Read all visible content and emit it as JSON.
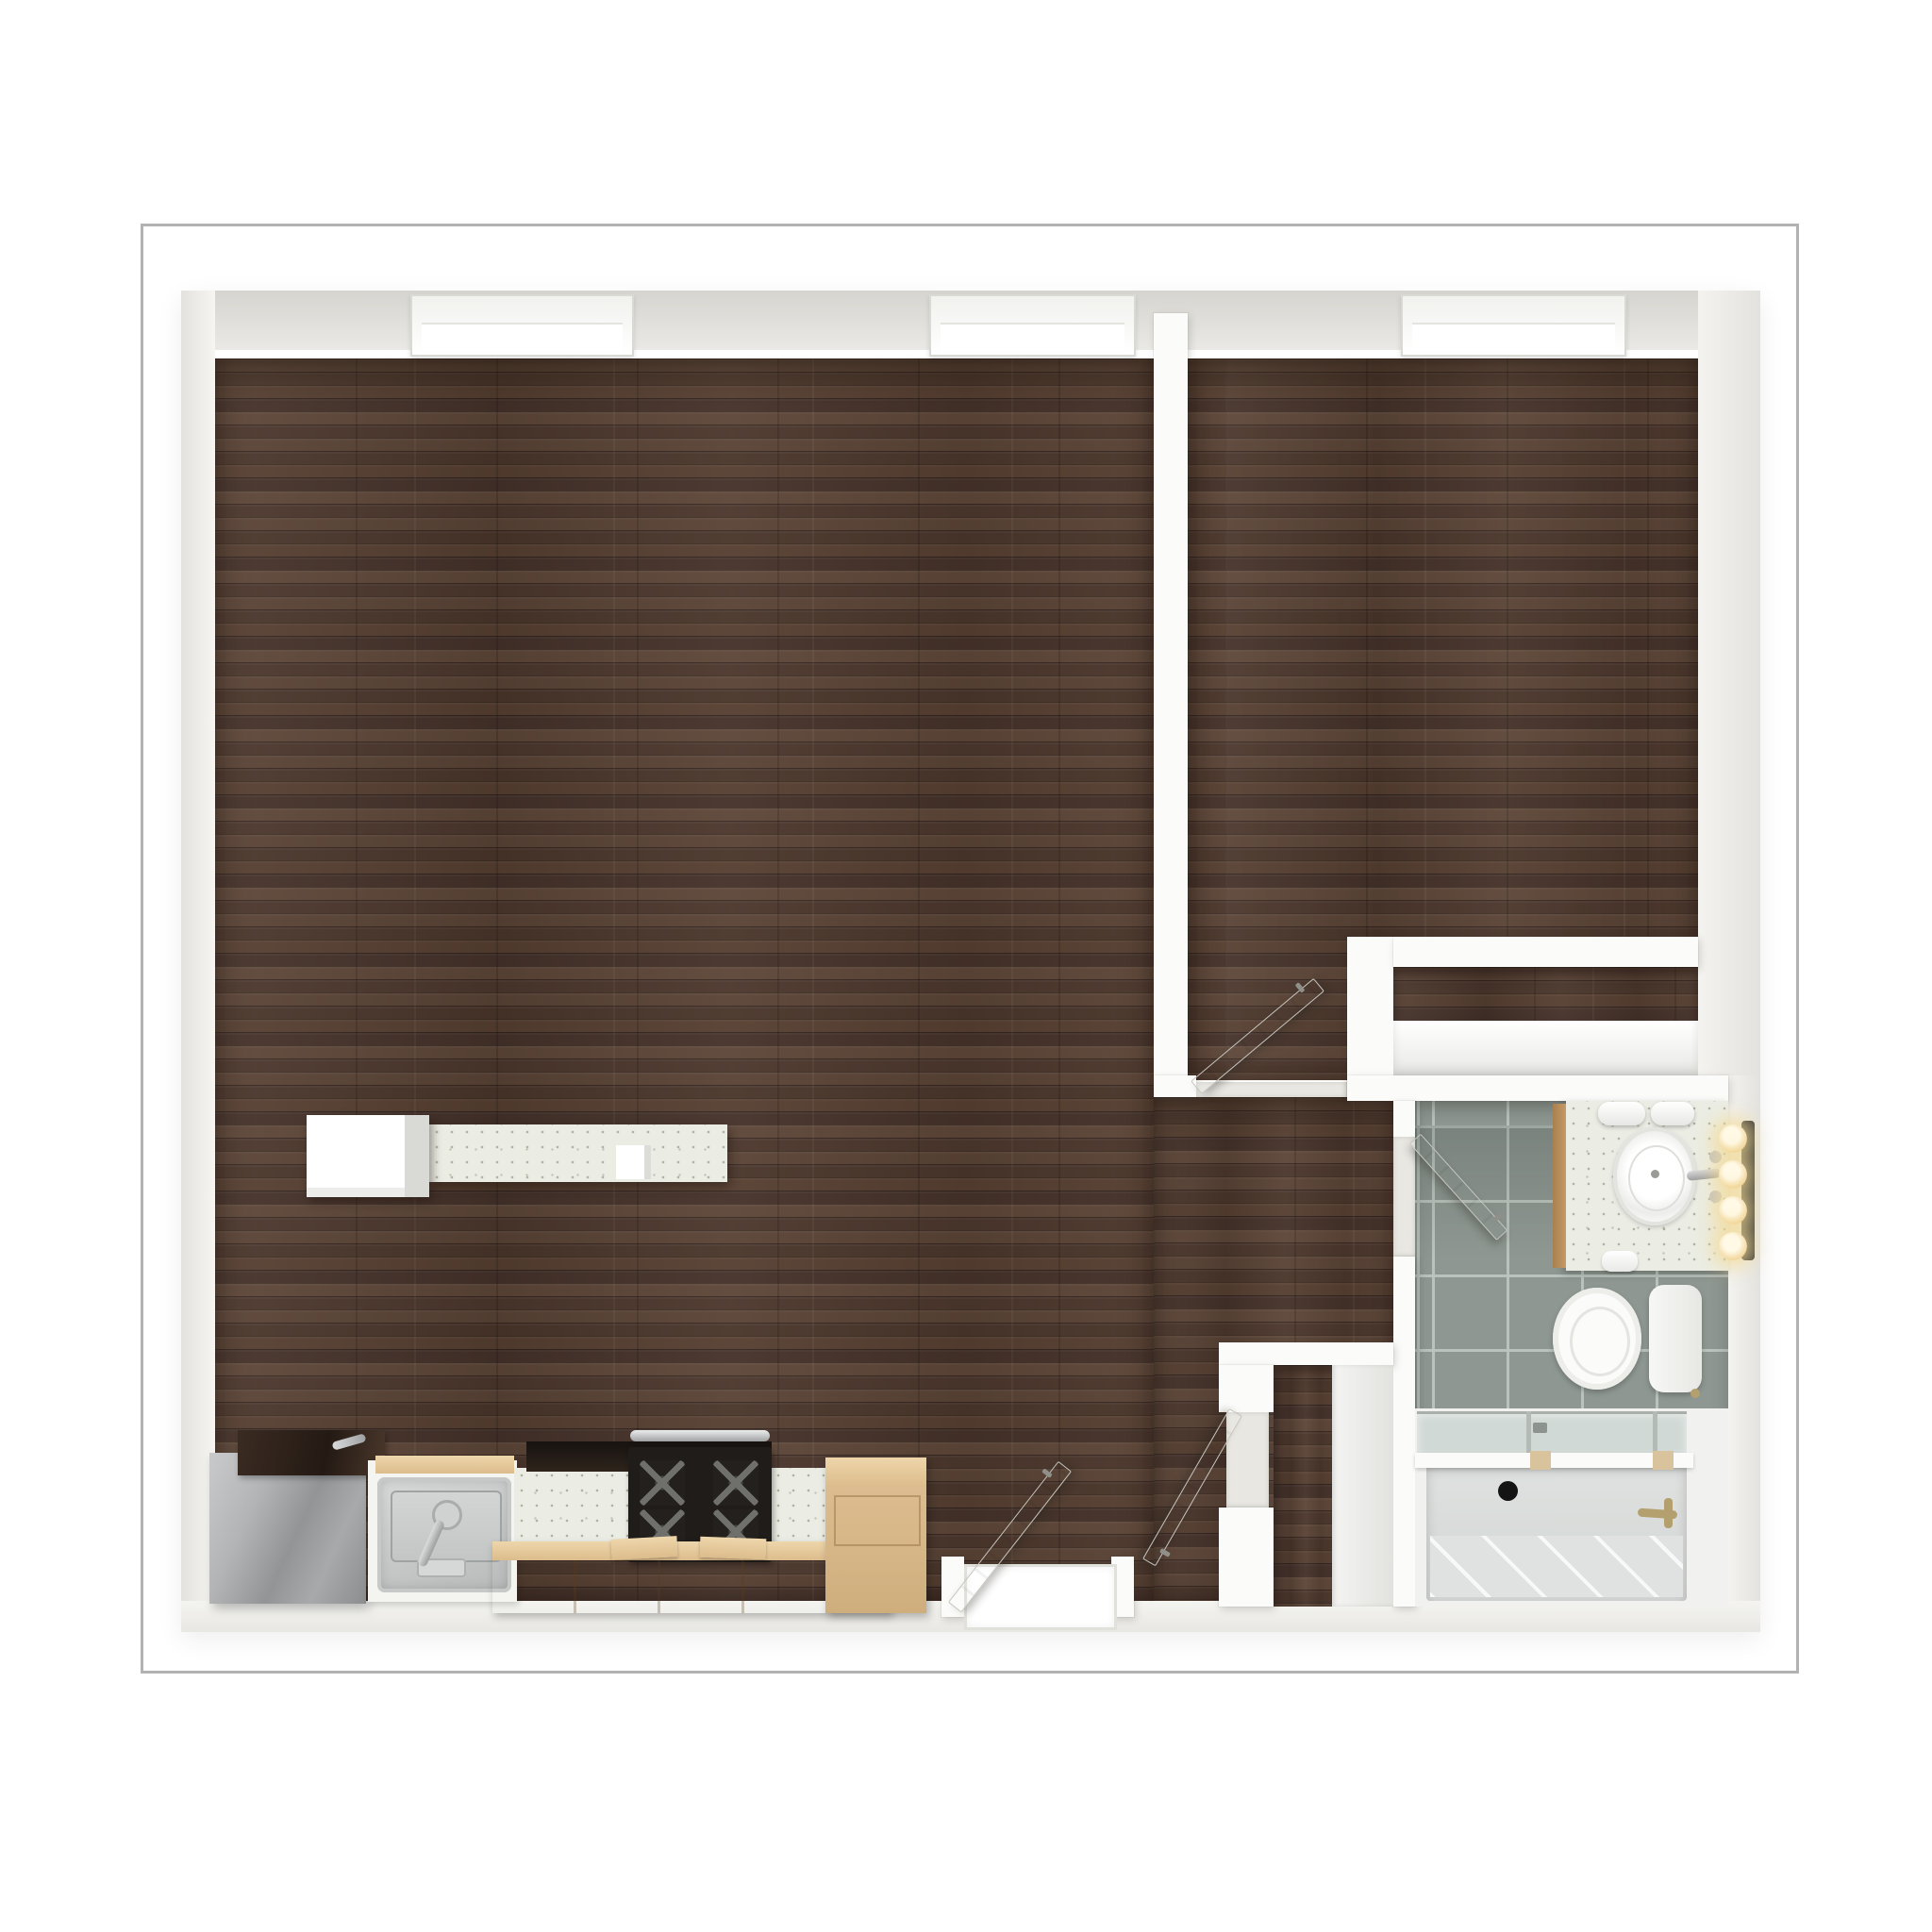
{
  "meta": {
    "kind": "3d-floor-plan-render",
    "view": "top-down orthographic",
    "visible_text": "none",
    "plan_label": "One-bedroom apartment floor plan"
  },
  "palette": {
    "page_background": "#ffffff",
    "frame_stroke": "#b2b2b2",
    "wall_white": "#fbfbf9",
    "ceiling_band": "#d7d6d1",
    "wood_floor_dark": "#4f3a2e",
    "wood_floor_light": "#5d4638",
    "bathroom_tile": "#8e9791",
    "tile_grout": "#bcc4bf",
    "counter_speckle": "#ebede5",
    "maple_cabinet": "#d9b988",
    "stainless_steel": "#a9aaac",
    "range_black": "#201c19",
    "tub_gray": "#d8dbd9",
    "bulb_glow": "#f3db94",
    "brass": "#b3a06e"
  },
  "apartment": {
    "rooms": [
      {
        "id": "living-kitchen",
        "label": "Open living room with kitchen along bottom wall",
        "floor": "dark walnut plank"
      },
      {
        "id": "bedroom",
        "label": "Bedroom (upper right)",
        "floor": "dark walnut plank"
      },
      {
        "id": "hallway",
        "label": "Entry hallway connecting living room, bedroom and bathroom",
        "floor": "dark walnut plank"
      },
      {
        "id": "bathroom",
        "label": "Bathroom (lower right)",
        "floor": "sage gray ceramic tile"
      },
      {
        "id": "bedroom-closet",
        "label": "Bedroom closet with white shelf",
        "floor": "dark walnut plank"
      },
      {
        "id": "entry-closet",
        "label": "Entry closet beside bathroom",
        "floor": "dark walnut plank"
      }
    ],
    "windows": [
      {
        "id": "window-living-left",
        "wall": "top",
        "room": "living-kitchen"
      },
      {
        "id": "window-living-right",
        "wall": "top",
        "room": "living-kitchen"
      },
      {
        "id": "window-bedroom",
        "wall": "top",
        "room": "bedroom"
      }
    ],
    "doors": [
      {
        "id": "entry-door",
        "label": "Apartment entry door, open, bottom wall",
        "state": "open"
      },
      {
        "id": "bedroom-door",
        "label": "Bedroom door, open into bedroom",
        "state": "open"
      },
      {
        "id": "bathroom-door",
        "label": "Bathroom door, open into bathroom",
        "state": "open"
      },
      {
        "id": "entry-closet-door",
        "label": "Entry closet door, open into hallway",
        "state": "open"
      }
    ]
  },
  "fixtures": {
    "refrigerator": {
      "label": "Stainless steel refrigerator with dark top"
    },
    "kitchen_sink": {
      "label": "Stainless kitchen sink with faucet in white cabinet"
    },
    "kitchen_counter": {
      "label": "Speckled quartz kitchen counter"
    },
    "range": {
      "label": "Black gas range with four burners and steel handle"
    },
    "base_cabinets": {
      "label": "Maple base cabinets"
    },
    "tall_cabinet": {
      "label": "Tall maple cabinet"
    },
    "island": {
      "label": "Kitchen island with white cabinet and speckled counter"
    },
    "vanity": {
      "label": "Bathroom vanity with oval sink, faucet and rolled towels"
    },
    "vanity_lights": {
      "label": "Vanity light bar with four glowing bulbs",
      "bulb_count": 4
    },
    "toilet": {
      "label": "Toilet with tank against right wall"
    },
    "bathtub": {
      "label": "Bathtub with sliding glass screen, drain and brass faucet"
    },
    "closet_shelf": {
      "label": "White closet shelf"
    },
    "toilet_paper": {
      "label": "Toilet paper roll holder"
    }
  }
}
